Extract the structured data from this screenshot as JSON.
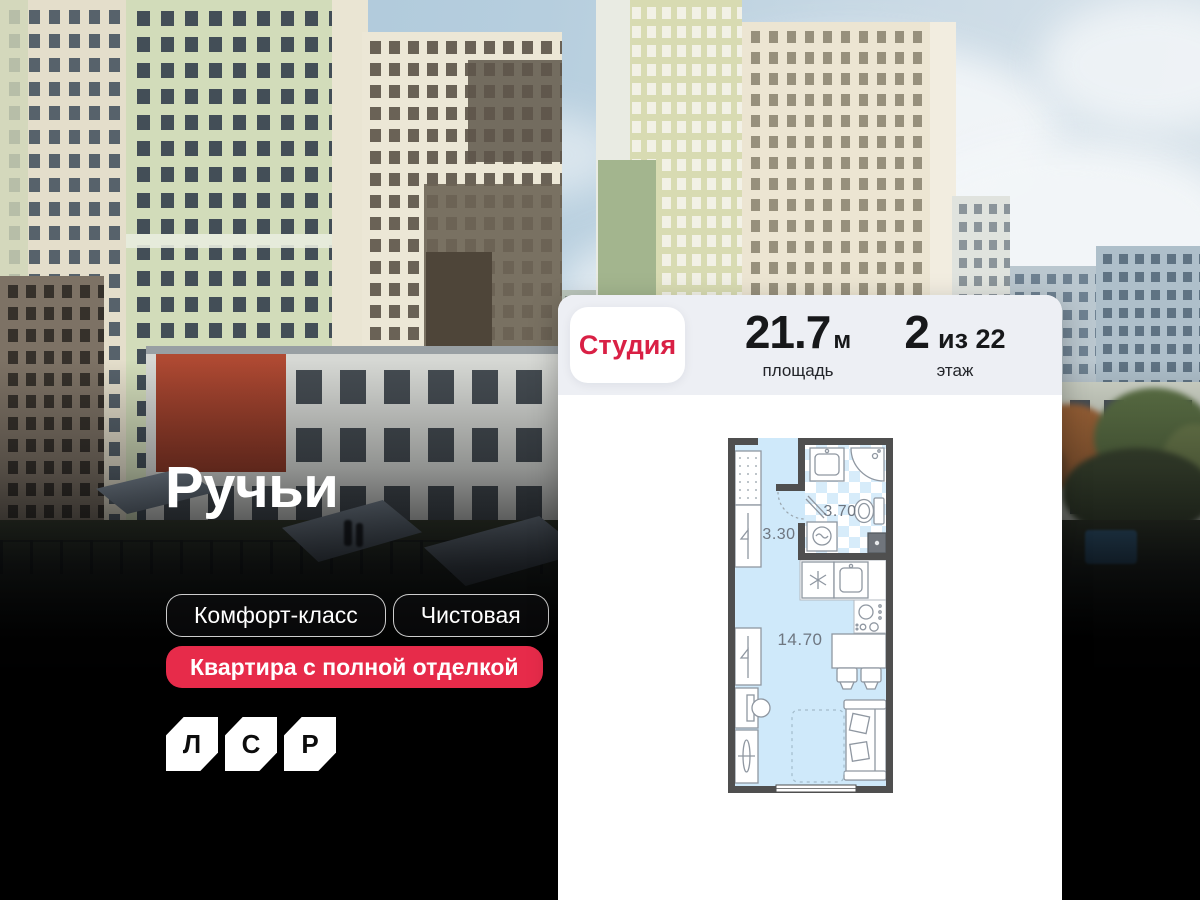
{
  "hero": {
    "title": "Ручьи",
    "tags": [
      {
        "label": "Комфорт-класс"
      },
      {
        "label": "Чистовая"
      }
    ],
    "highlight_tag": "Квартира с полной отделкой",
    "logo": {
      "letters": [
        "Л",
        "С",
        "Р"
      ]
    }
  },
  "card": {
    "type_chip": "Студия",
    "stats": [
      {
        "value": "21.7",
        "unit": "м",
        "label": "площадь"
      },
      {
        "value": "2",
        "unit": "из 22",
        "label": "этаж"
      }
    ]
  },
  "floor_plan": {
    "rooms": [
      {
        "name": "hallway",
        "area": "3.30"
      },
      {
        "name": "bathroom",
        "area": "3.70"
      },
      {
        "name": "living-kitchen",
        "area": "14.70"
      }
    ]
  },
  "colors": {
    "brand_red": "#e72b4a",
    "chip_text_red": "#d92045",
    "card_header_bg": "#edeff4",
    "plan_wall": "#4f4f4f",
    "plan_floor": "#cfe9fa",
    "plan_tile_blue": "#d7ecfa"
  }
}
